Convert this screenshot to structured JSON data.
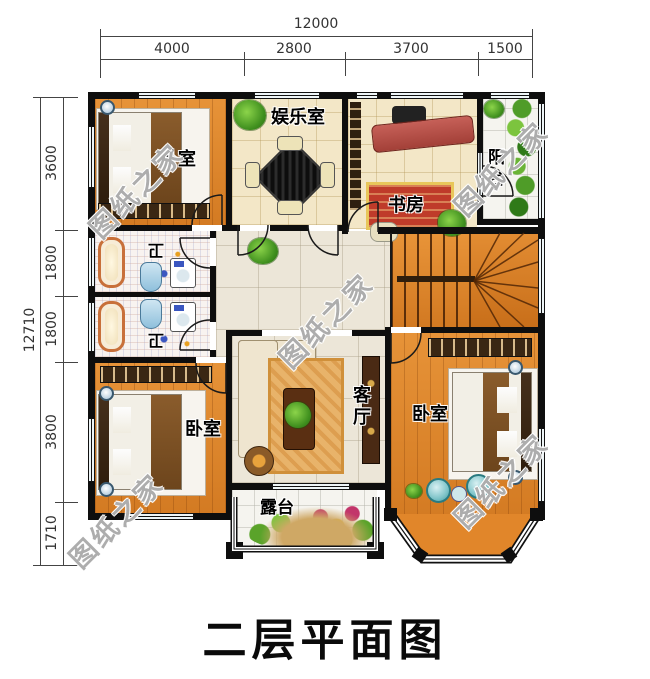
{
  "title": "二层平面图",
  "watermark": "图纸之家",
  "dimensions": {
    "top": {
      "total": "12000",
      "segments": [
        "4000",
        "2800",
        "3700",
        "1500"
      ]
    },
    "left": {
      "total": "12710",
      "segments": [
        "3600",
        "1800",
        "1800",
        "3800",
        "1710"
      ]
    }
  },
  "rooms": {
    "bedroom_top_left": "卧室",
    "entertainment": "娱乐室",
    "study": "书房",
    "balcony": "阳台",
    "bath_upper": "卫",
    "bath_lower": "卫",
    "living": "客厅",
    "bedroom_bottom_left": "卧室",
    "bedroom_right": "卧室",
    "terrace": "露台"
  },
  "colors": {
    "wall": "#0e0e0e",
    "wood_floor": "#e1862a",
    "tile_beige": "#f3e7c7",
    "tile_hall": "#ece6d8",
    "tile_white": "#f5f4ef",
    "watermark_gray": "#7a7a7a",
    "dimension_text": "#333333",
    "rug_red": "#bf3b2a",
    "rug_orange": "#e8b36a"
  }
}
